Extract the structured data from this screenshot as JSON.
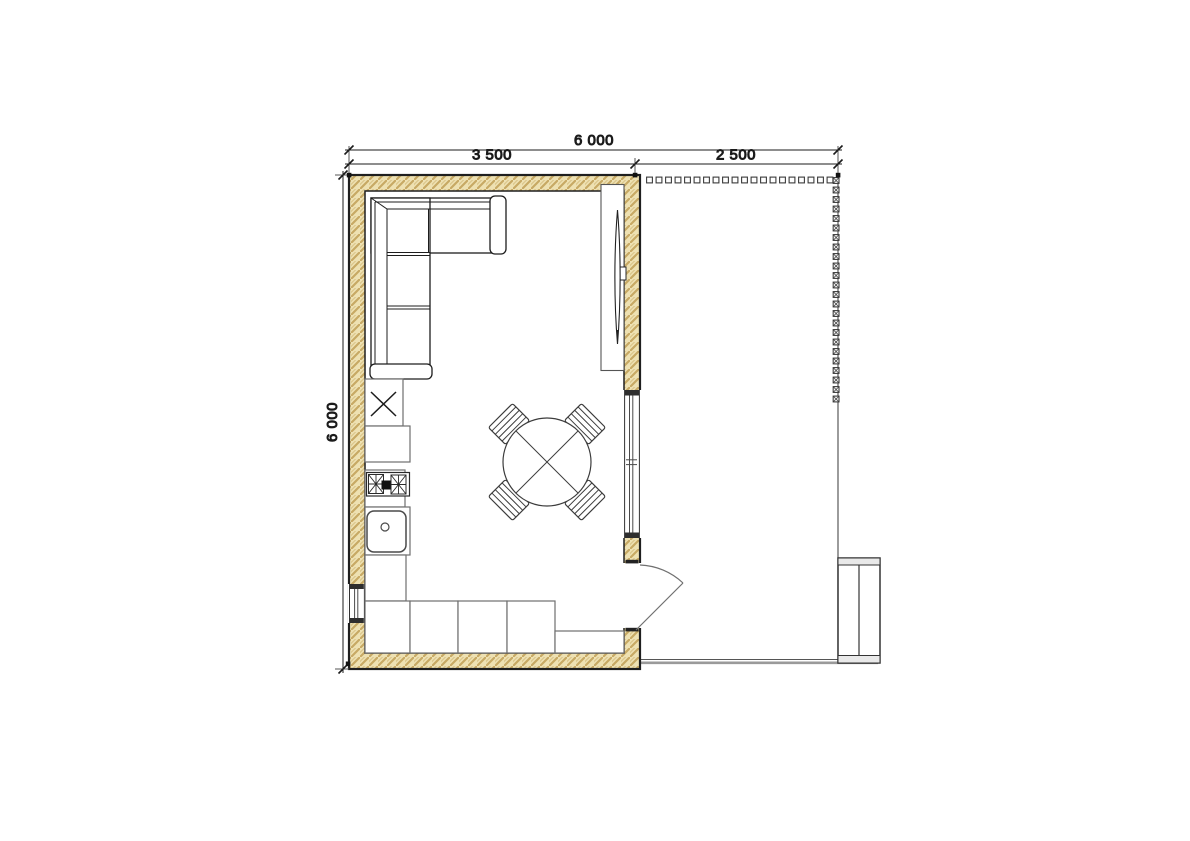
{
  "drawing": {
    "dimension_labels": {
      "overall_width": "6 000",
      "room_width": "3 500",
      "terrace_width": "2 500",
      "overall_depth": "6 000"
    },
    "dimension_values_mm": {
      "overall_width": 6000,
      "room_width": 3500,
      "terrace_width": 2500,
      "overall_depth": 6000
    },
    "colors": {
      "background": "#ffffff",
      "wall_fill": "#eee1b2",
      "wall_hatch": "#c7a964",
      "outline": "#1f1f1f",
      "furniture_line": "#3c3c3c",
      "counter_line": "#6f6f6f",
      "door_swing_line": "#707070",
      "ground_line": "#9a9a9a"
    },
    "inventory": {
      "furniture": [
        "corner-sofa",
        "wall-tv",
        "tv-panel",
        "round-dining-table",
        "dining-chair (x4)",
        "tall-cabinet-with-x",
        "kitchen-counter-run",
        "cooktop-2-burner",
        "kitchen-sink",
        "outdoor-cabinet"
      ],
      "openings": [
        "right-window",
        "left-window",
        "entry-door"
      ],
      "site": [
        "terrace-post-line",
        "ground-edge-line"
      ]
    }
  }
}
